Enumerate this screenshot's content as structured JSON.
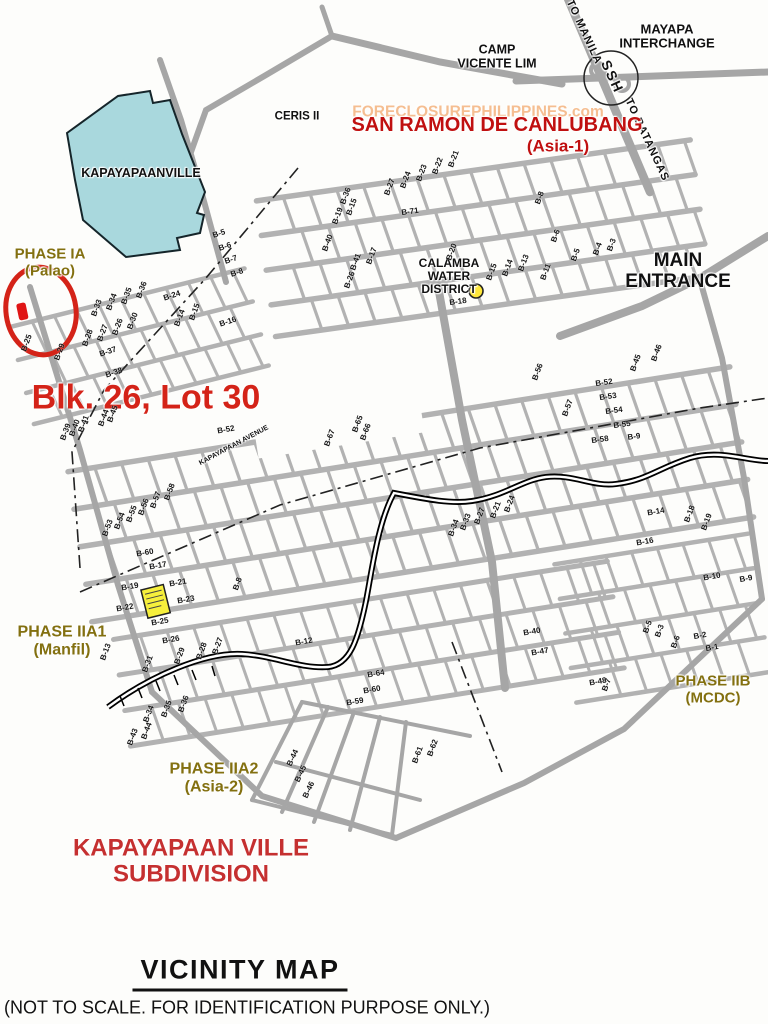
{
  "title_block": {
    "title": "VICINITY MAP",
    "note": "(NOT TO SCALE. FOR IDENTIFICATION PURPOSE ONLY.)"
  },
  "colors": {
    "red_title": "#c01010",
    "red_mark": "#d42318",
    "red_sub": "#c53030",
    "olive": "#837010",
    "street_gray": "#ababab",
    "water_blue": "#a9d8dd",
    "highlight_yellow": "#f6ef3c",
    "dot_yellow": "#ffe83a",
    "watermark_orange": "#f08c3c",
    "ink": "#111111"
  },
  "map": {
    "features": {
      "subject_circle": {
        "name": "subject-lot-circle",
        "color": "#d42318"
      },
      "subject_marker": {
        "name": "subject-lot-marker",
        "color": "#e01515"
      },
      "water_district_dot": {
        "name": "calamba-water-district-dot",
        "color": "#ffe83a"
      },
      "model_house_block": {
        "name": "highlighted-block",
        "color": "#f6ef3c"
      },
      "kapayapaanville_area": {
        "name": "kapayapaanville-area",
        "color": "#a9d8dd"
      },
      "interchange_circle": {
        "name": "mayapa-interchange-circle"
      },
      "creek_line": {
        "name": "creek-railroad-line",
        "color": "#000000"
      }
    },
    "landmarks": [
      {
        "name": "mayapa-interchange-label",
        "t": "MAYAPA\nINTERCHANGE",
        "x": 667,
        "y": 37,
        "s": 13,
        "c": "ink"
      },
      {
        "name": "to-manila-label",
        "t": "TO MANILA",
        "x": 584,
        "y": 32,
        "s": 11,
        "c": "ink",
        "r": 65,
        "ls": 1
      },
      {
        "name": "ssh-label",
        "t": "SSH",
        "x": 612,
        "y": 77,
        "s": 14,
        "c": "ink",
        "r": 65,
        "ls": 2
      },
      {
        "name": "to-batangas-label",
        "t": "TO BATANGAS",
        "x": 647,
        "y": 140,
        "s": 11,
        "c": "ink",
        "r": 65,
        "ls": 1
      },
      {
        "name": "camp-vicente-lim-label",
        "t": "CAMP\nVICENTE LIM",
        "x": 497,
        "y": 57,
        "s": 12.5,
        "c": "ink"
      },
      {
        "name": "ceris-ii-label",
        "t": "CERIS II",
        "x": 297,
        "y": 117,
        "s": 11.5,
        "c": "ink"
      },
      {
        "name": "watermark",
        "t": "FORECLOSUREPHILIPPINES.com",
        "x": 478,
        "y": 112,
        "s": 15.5,
        "c": "watermark_orange",
        "o": 0.55
      },
      {
        "name": "san-ramon-label",
        "t": "SAN RAMON DE CANLUBANG",
        "x": 497,
        "y": 125,
        "s": 20,
        "c": "red_title"
      },
      {
        "name": "asia-1-label",
        "t": "(Asia-1)",
        "x": 558,
        "y": 147,
        "s": 17,
        "c": "red_title"
      },
      {
        "name": "kapayapaanville-label",
        "t": "KAPAYAPAANVILLE",
        "x": 141,
        "y": 174,
        "s": 12.5,
        "c": "ink"
      },
      {
        "name": "phase-ia-label",
        "t": "PHASE IA\n(Palao)",
        "x": 50,
        "y": 263,
        "s": 15,
        "c": "olive"
      },
      {
        "name": "subject-lot-label",
        "t": "Blk. 26, Lot 30",
        "x": 146,
        "y": 398,
        "s": 34,
        "c": "red_mark"
      },
      {
        "name": "calamba-water-district-label",
        "t": "CALAMBA\nWATER\nDISTRICT",
        "x": 449,
        "y": 277,
        "s": 12,
        "c": "ink"
      },
      {
        "name": "main-entrance-label",
        "t": "MAIN\nENTRANCE",
        "x": 678,
        "y": 272,
        "s": 19,
        "c": "ink"
      },
      {
        "name": "phase-iia1-label",
        "t": "PHASE IIA1\n(Manfil)",
        "x": 62,
        "y": 641,
        "s": 16,
        "c": "olive"
      },
      {
        "name": "phase-iib-label",
        "t": "PHASE IIB\n(MCDC)",
        "x": 713,
        "y": 690,
        "s": 15,
        "c": "olive"
      },
      {
        "name": "phase-iia2-label",
        "t": "PHASE IIA2\n(Asia-2)",
        "x": 214,
        "y": 778,
        "s": 16,
        "c": "olive"
      },
      {
        "name": "subdivision-label",
        "t": "KAPAYAPAAN VILLE\nSUBDIVISION",
        "x": 191,
        "y": 862,
        "s": 24,
        "c": "red_sub"
      },
      {
        "name": "kapayapaan-avenue-label",
        "t": "KAPAYAPAAN AVENUE",
        "x": 234,
        "y": 446,
        "s": 7,
        "c": "ink",
        "r": -28
      }
    ],
    "block_labels": [
      [
        "B-25",
        27,
        343,
        -70
      ],
      [
        "B-29",
        60,
        352,
        -70
      ],
      [
        "B-28",
        88,
        338,
        -70
      ],
      [
        "B-27",
        103,
        333,
        -70
      ],
      [
        "B-26",
        118,
        327,
        -70
      ],
      [
        "B-30",
        133,
        321,
        -70
      ],
      [
        "B-33",
        97,
        308,
        -70
      ],
      [
        "B-34",
        112,
        302,
        -70
      ],
      [
        "B-35",
        127,
        296,
        -70
      ],
      [
        "B-36",
        142,
        290,
        -70
      ],
      [
        "B-24",
        172,
        296,
        -18
      ],
      [
        "B-14",
        180,
        318,
        -70
      ],
      [
        "B-15",
        195,
        312,
        -70
      ],
      [
        "B-16",
        228,
        322,
        -18
      ],
      [
        "B-37",
        108,
        352,
        -18
      ],
      [
        "B-38",
        114,
        373,
        -18
      ],
      [
        "B-5",
        219,
        234,
        -18
      ],
      [
        "B-6",
        225,
        247,
        -18
      ],
      [
        "B-7",
        231,
        260,
        -18
      ],
      [
        "B-8",
        237,
        273,
        -18
      ],
      [
        "B-19",
        338,
        216,
        -70
      ],
      [
        "B-15",
        352,
        207,
        -70
      ],
      [
        "B-27",
        390,
        187,
        -70
      ],
      [
        "B-24",
        406,
        180,
        -70
      ],
      [
        "B-23",
        422,
        173,
        -70
      ],
      [
        "B-22",
        438,
        166,
        -70
      ],
      [
        "B-21",
        454,
        159,
        -70
      ],
      [
        "B-71",
        410,
        212,
        -8
      ],
      [
        "B-40",
        328,
        243,
        -70
      ],
      [
        "B-41",
        356,
        262,
        -70
      ],
      [
        "B-17",
        372,
        256,
        -70
      ],
      [
        "B-26",
        350,
        280,
        -70
      ],
      [
        "B-20",
        452,
        252,
        -70
      ],
      [
        "B-15",
        492,
        272,
        -70
      ],
      [
        "B-14",
        508,
        268,
        -70
      ],
      [
        "B-13",
        524,
        263,
        -70
      ],
      [
        "B-11",
        546,
        272,
        -70
      ],
      [
        "B-18",
        458,
        302,
        -8
      ],
      [
        "B-5",
        576,
        255,
        -70
      ],
      [
        "B-4",
        598,
        249,
        -70
      ],
      [
        "B-3",
        612,
        245,
        -70
      ],
      [
        "B-8",
        540,
        198,
        -70
      ],
      [
        "B-6",
        556,
        236,
        -70
      ],
      [
        "B-36",
        346,
        196,
        -70
      ],
      [
        "B-46",
        657,
        353,
        -70
      ],
      [
        "B-45",
        636,
        363,
        -70
      ],
      [
        "B-52",
        604,
        383,
        -8
      ],
      [
        "B-53",
        608,
        397,
        -8
      ],
      [
        "B-54",
        614,
        411,
        -8
      ],
      [
        "B-55",
        622,
        425,
        -8
      ],
      [
        "B-9",
        634,
        437,
        -8
      ],
      [
        "B-56",
        538,
        372,
        -70
      ],
      [
        "B-57",
        568,
        408,
        -70
      ],
      [
        "B-58",
        600,
        440,
        -8
      ],
      [
        "B-39",
        66,
        432,
        -70
      ],
      [
        "B-40",
        75,
        428,
        -70
      ],
      [
        "B-41",
        84,
        424,
        -70
      ],
      [
        "B-44",
        104,
        418,
        -70
      ],
      [
        "B-45",
        113,
        414,
        -70
      ],
      [
        "B-52",
        226,
        430,
        -10
      ],
      [
        "B-53",
        108,
        528,
        -70
      ],
      [
        "B-54",
        120,
        521,
        -70
      ],
      [
        "B-55",
        132,
        514,
        -70
      ],
      [
        "B-56",
        144,
        507,
        -70
      ],
      [
        "B-57",
        156,
        500,
        -70
      ],
      [
        "B-58",
        170,
        492,
        -70
      ],
      [
        "B-60",
        145,
        553,
        -10
      ],
      [
        "B-17",
        158,
        566,
        -10
      ],
      [
        "B-67",
        330,
        438,
        -70
      ],
      [
        "B-65",
        358,
        424,
        -70
      ],
      [
        "B-66",
        366,
        432,
        -70
      ],
      [
        "B-27",
        480,
        516,
        -70
      ],
      [
        "B-33",
        466,
        522,
        -70
      ],
      [
        "B-34",
        454,
        528,
        -70
      ],
      [
        "B-21",
        496,
        510,
        -70
      ],
      [
        "B-24",
        510,
        504,
        -70
      ],
      [
        "B-10",
        712,
        577,
        -10
      ],
      [
        "B-9",
        746,
        579,
        -10
      ],
      [
        "B-14",
        656,
        512,
        -10
      ],
      [
        "B-16",
        645,
        542,
        -10
      ],
      [
        "B-18",
        690,
        514,
        -70
      ],
      [
        "B-19",
        707,
        522,
        -70
      ],
      [
        "B-19",
        130,
        587,
        -10
      ],
      [
        "B-21",
        178,
        583,
        -10
      ],
      [
        "B-22",
        125,
        608,
        -10
      ],
      [
        "B-23",
        186,
        600,
        -10
      ],
      [
        "B-25",
        160,
        622,
        -10
      ],
      [
        "B-26",
        171,
        640,
        -10
      ],
      [
        "B-13",
        106,
        652,
        -70
      ],
      [
        "B-29",
        180,
        656,
        -70
      ],
      [
        "B-28",
        202,
        651,
        -70
      ],
      [
        "B-27",
        218,
        646,
        -70
      ],
      [
        "B-31",
        148,
        664,
        -70
      ],
      [
        "B-34",
        149,
        714,
        -70
      ],
      [
        "B-35",
        167,
        709,
        -70
      ],
      [
        "B-36",
        184,
        704,
        -70
      ],
      [
        "B-44",
        147,
        731,
        -70
      ],
      [
        "B-43",
        133,
        737,
        -70
      ],
      [
        "B-8",
        238,
        584,
        -70
      ],
      [
        "B-12",
        304,
        642,
        -10
      ],
      [
        "B-64",
        376,
        674,
        -10
      ],
      [
        "B-60",
        372,
        690,
        -10
      ],
      [
        "B-59",
        355,
        702,
        -10
      ],
      [
        "B-62",
        433,
        748,
        -70
      ],
      [
        "B-61",
        418,
        755,
        -70
      ],
      [
        "B-44",
        293,
        758,
        -65
      ],
      [
        "B-45",
        301,
        774,
        -65
      ],
      [
        "B-46",
        309,
        790,
        -65
      ],
      [
        "B-47",
        540,
        652,
        -10
      ],
      [
        "B-40",
        532,
        632,
        -10
      ],
      [
        "B-48",
        598,
        682,
        -10
      ],
      [
        "B-7",
        607,
        685,
        -70
      ],
      [
        "B-5",
        648,
        627,
        -70
      ],
      [
        "B-3",
        660,
        631,
        -70
      ],
      [
        "B-2",
        700,
        636,
        -10
      ],
      [
        "B-1",
        712,
        648,
        -10
      ],
      [
        "B-6",
        676,
        642,
        -70
      ]
    ]
  }
}
